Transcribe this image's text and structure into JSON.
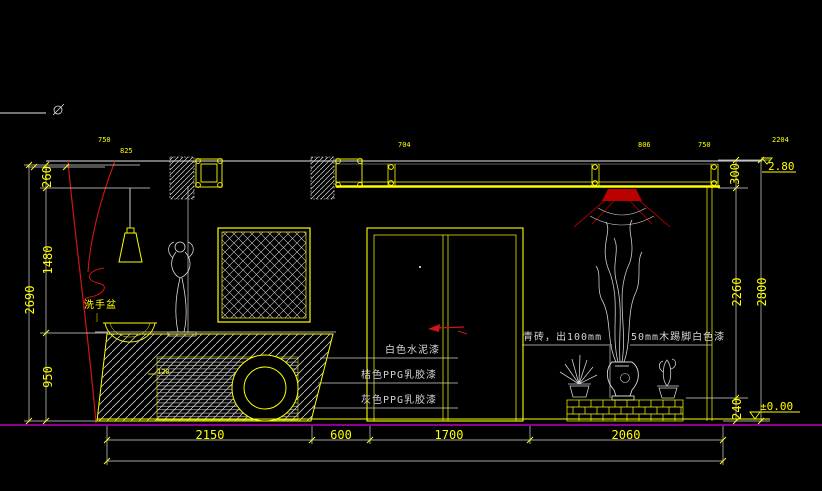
{
  "colors": {
    "background": "#000000",
    "accent_yellow": "#ffff00",
    "line_white": "#d9d9d9",
    "mark_red": "#cc1111",
    "floor_magenta": "#c000c0"
  },
  "dims": {
    "left": {
      "seg_260": "260",
      "seg_1480": "1480",
      "seg_950": "950",
      "total": "2690"
    },
    "right": {
      "seg_300": "300",
      "seg_2260": "2260",
      "seg_240": "240",
      "total": "2800"
    },
    "bottom": {
      "seg_2150": "2150",
      "seg_600": "600",
      "seg_1700": "1700",
      "seg_2060": "2060"
    },
    "small_top": {
      "n1": "704",
      "n2": "806",
      "n3": "750",
      "n4": "2204"
    },
    "small_left": {
      "n1": "750",
      "n2": "825"
    },
    "counter_offset": "120"
  },
  "levels": {
    "ceiling": "2.80",
    "floor": "±0.00"
  },
  "annotations": {
    "washbasin": "洗手盆",
    "paint_white": "白色水泥漆",
    "paint_orange": "桔色PPG乳胶漆",
    "paint_gray": "灰色PPG乳胶漆",
    "brick": "青砖，出100mm",
    "skirting": "50mm木踢脚白色漆"
  }
}
